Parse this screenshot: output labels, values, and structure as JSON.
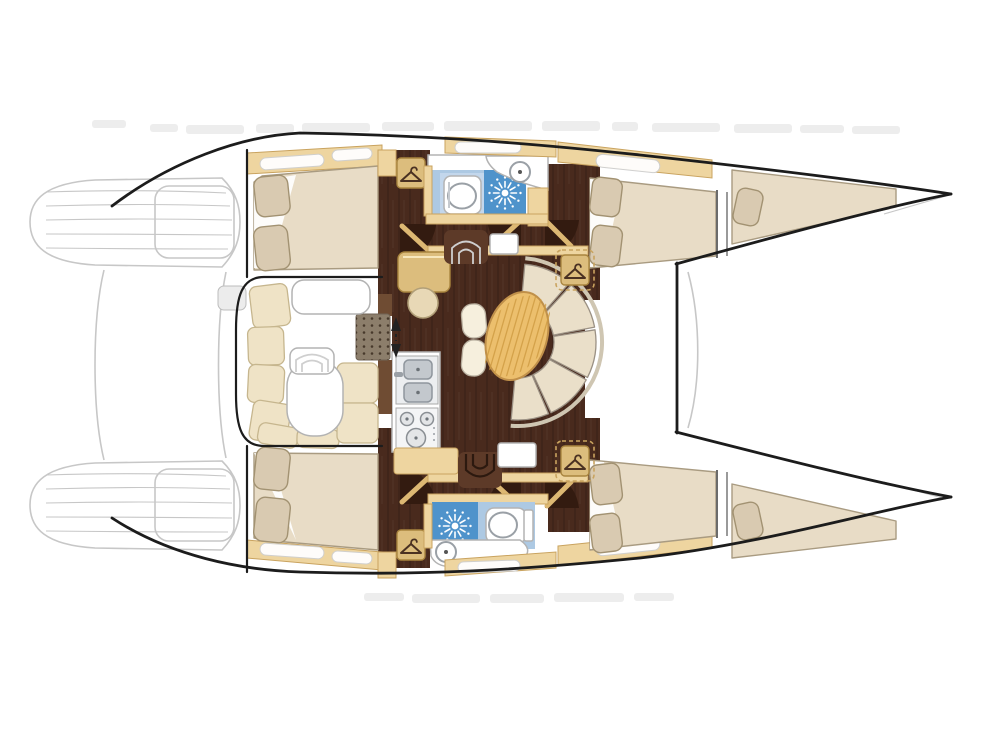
{
  "plan": {
    "vessel_type": "catamaran-floor-plan",
    "orientation": "bows-right",
    "areas": [
      "stern-platform-port",
      "stern-platform-starboard",
      "aft-cockpit",
      "aft-cabin-port",
      "aft-cabin-starboard",
      "bathroom-port",
      "bathroom-starboard",
      "salon-dinette",
      "galley",
      "chart-table",
      "forward-cabin-port",
      "forward-cabin-starboard",
      "bow-berth-port",
      "bow-berth-starboard",
      "foredeck"
    ]
  },
  "icons": {
    "hanger": "clothes-hanger wardrobe symbol",
    "shower_drain": "sunburst shower symbol",
    "toilet": "toilet bowl with seat",
    "basin": "round wash basin",
    "double_sink": "twin rectangular galley sinks",
    "stove": "three-burner hob",
    "companionway_arrows": "up-down passage arrows",
    "steps": "nested curved companionway steps"
  },
  "colors": {
    "ink": "#1c1c1c",
    "gray_line": "#c7c7c7",
    "tan": "#eed5a0",
    "tan_edge": "#c9a35f",
    "tan_box": "#dcbd7d",
    "tan_box_edge": "#a9853f",
    "hanger_glyph": "#4a3122",
    "bed": "#e8dcc6",
    "bed_edge": "#a99b81",
    "pillow": "#d9cab1",
    "pillow_edge": "#a29272",
    "floor": "#492a1d",
    "floor_light": "#5d3a28",
    "floor_dark": "#331b10",
    "door_leaf": "#ddb873",
    "bath": "#adc9e3",
    "bath_light": "#c3d7ec",
    "shower": "#4f93cb",
    "furn_edge": "#b3b3b3",
    "wood": "#ecbf6d",
    "wood_line": "#cf9b42",
    "settee": "#eadfc9",
    "settee_edge": "#9b9184",
    "settee_rim": "#cfc6b2",
    "sink_steel": "#c3c8cd",
    "sink_dark": "#8f969d",
    "mat": "#8c7e6b",
    "mat_dot": "#47392b",
    "brown_panel": "#6f4c33",
    "gray_box": "#ececec",
    "cushion": "#efe3c6",
    "cushion_edge": "#c6b68e",
    "watermark": "#dcdcdc",
    "white": "#ffffff"
  }
}
